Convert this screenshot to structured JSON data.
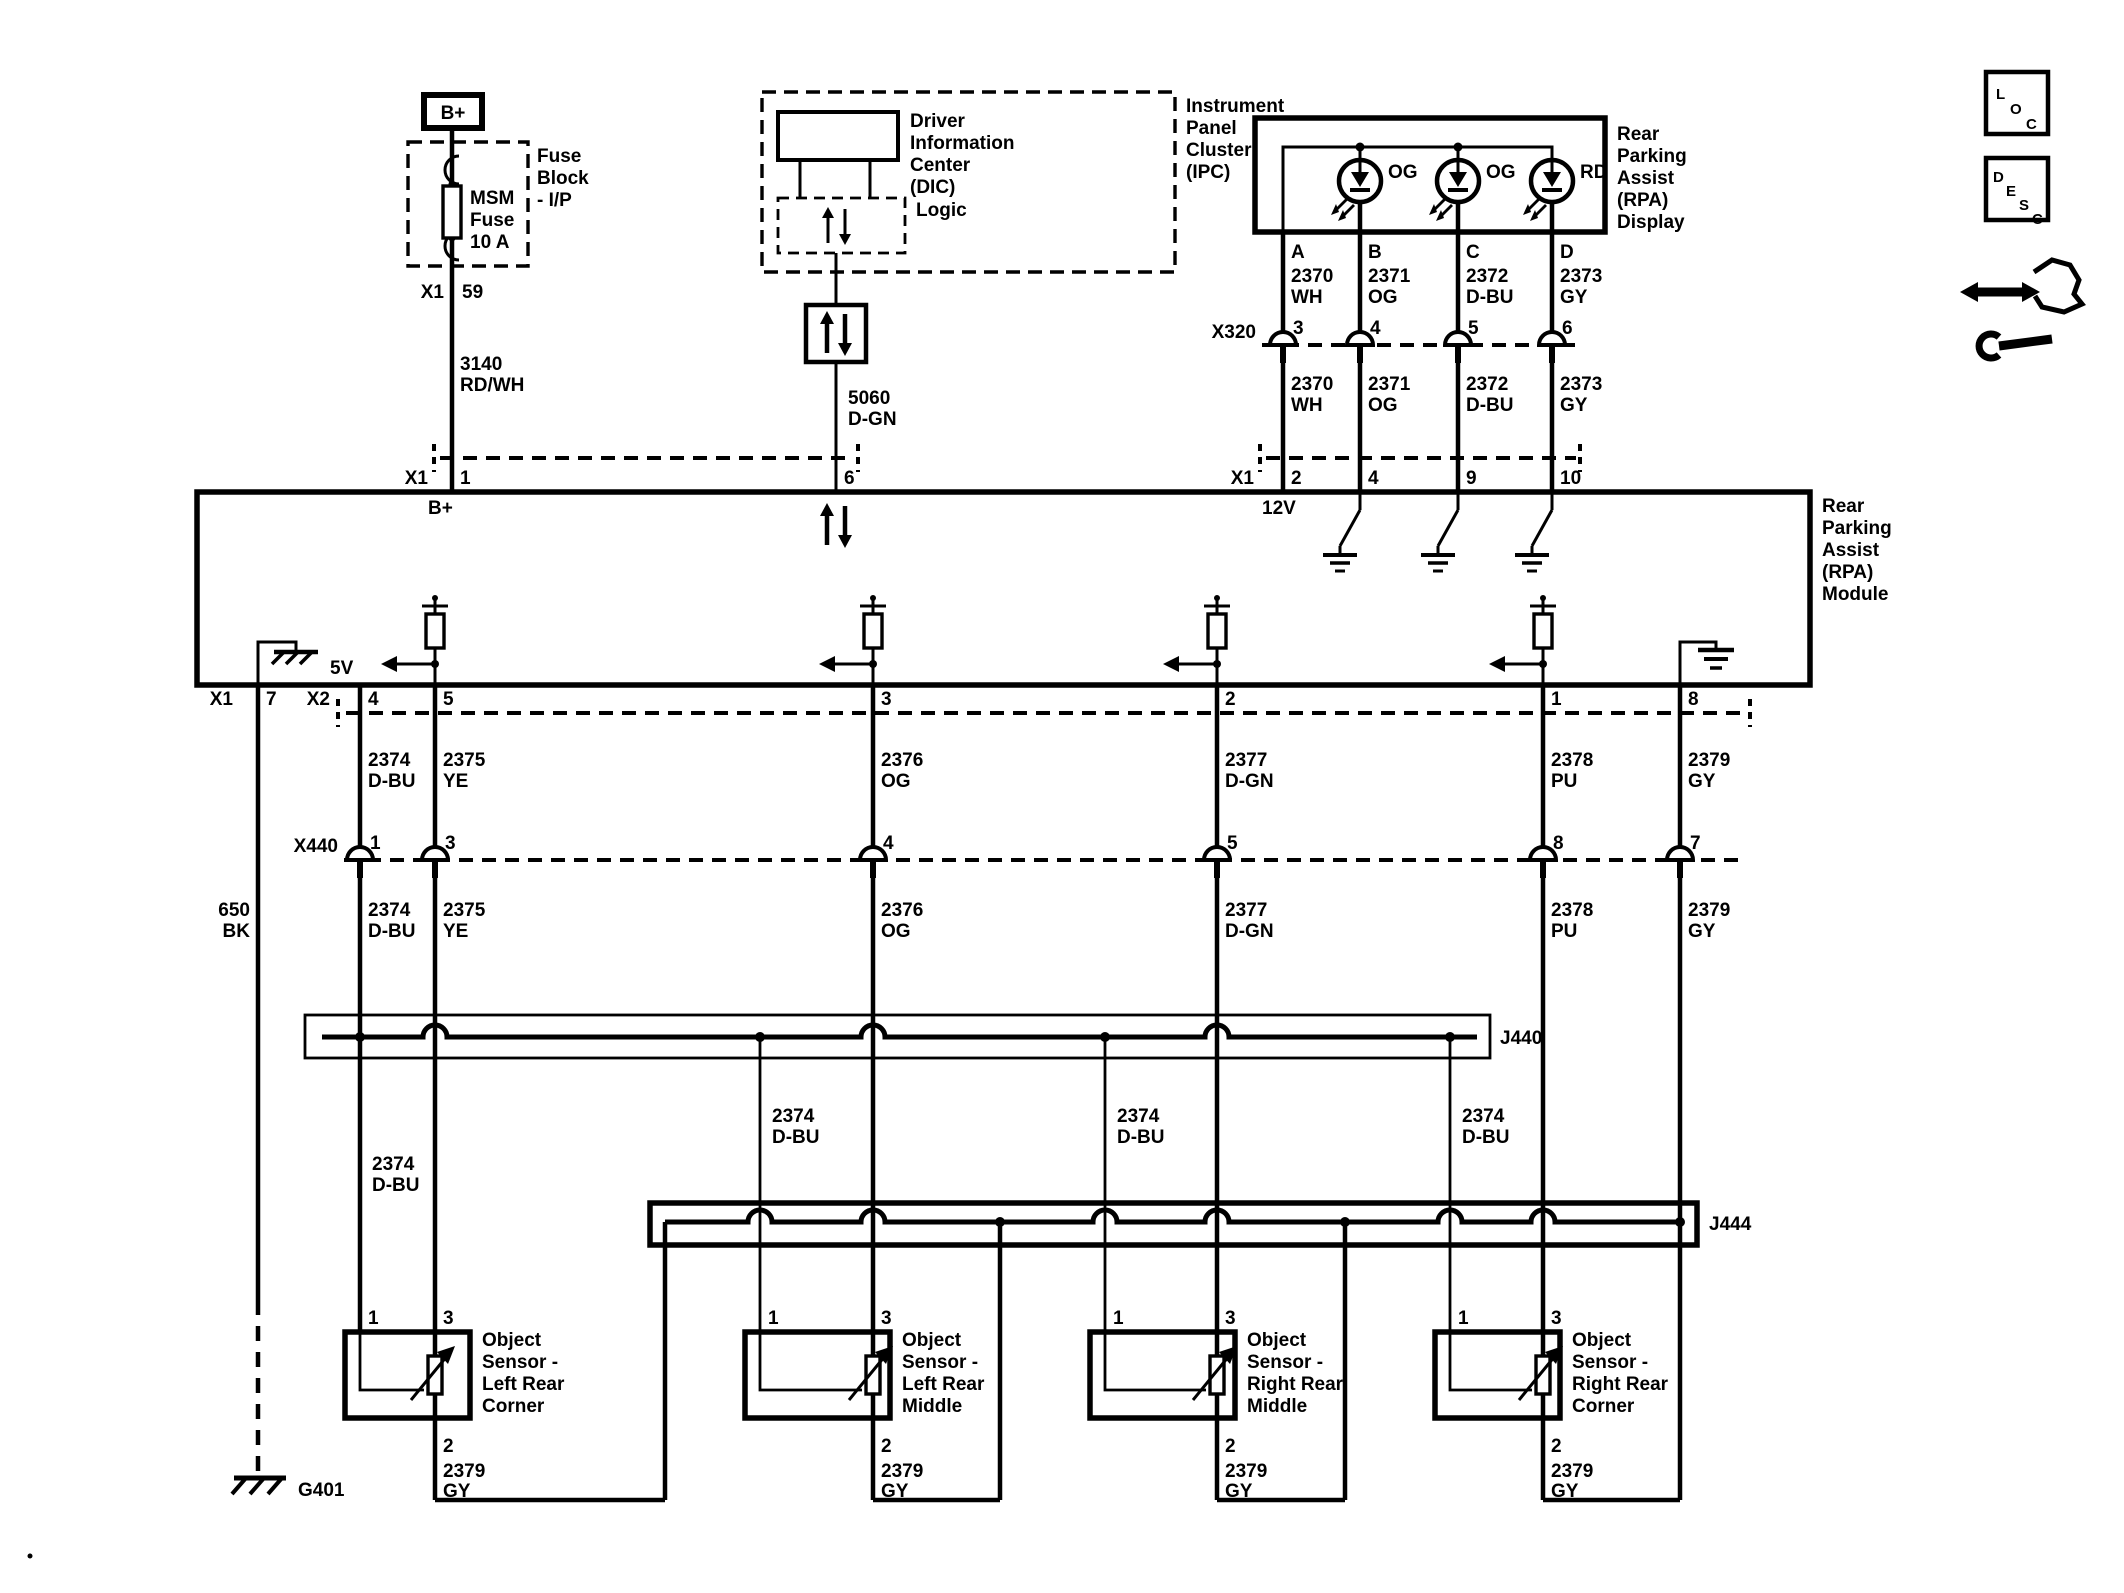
{
  "fuse": {
    "b_plus": "B+",
    "block_lines": [
      "Fuse",
      "Block",
      "- I/P"
    ],
    "name_lines": [
      "MSM",
      "Fuse",
      "10 A"
    ],
    "conn": "X1",
    "pin": "59"
  },
  "w3140": [
    "3140",
    "RD/WH"
  ],
  "ipc": {
    "label": [
      "Instrument",
      "Panel",
      "Cluster",
      "(IPC)"
    ],
    "dic": [
      "Driver",
      "Information",
      "Center",
      "(DIC)"
    ],
    "logic": "Logic"
  },
  "w5060": [
    "5060",
    "D-GN"
  ],
  "display": {
    "label": [
      "Rear",
      "Parking",
      "Assist",
      "(RPA)",
      "Display"
    ],
    "leds": [
      "OG",
      "OG",
      "RD"
    ],
    "pins": [
      "A",
      "B",
      "C",
      "D"
    ]
  },
  "w2370": [
    "2370",
    "WH"
  ],
  "w2371": [
    "2371",
    "OG"
  ],
  "w2372": [
    "2372",
    "D-BU"
  ],
  "w2373": [
    "2373",
    "GY"
  ],
  "x320": {
    "label": "X320",
    "pins": [
      "3",
      "4",
      "5",
      "6"
    ]
  },
  "x1_display": {
    "label": "X1",
    "pins": [
      "2",
      "4",
      "9",
      "10"
    ]
  },
  "x1_left": {
    "label": "X1",
    "pin1": "1",
    "pin6": "6"
  },
  "module": {
    "label": [
      "Rear",
      "Parking",
      "Assist",
      "(RPA)",
      "Module"
    ],
    "b_plus": "B+",
    "v12": "12V",
    "v5": "5V"
  },
  "x1_gnd": {
    "label": "X1",
    "pin": "7"
  },
  "x2": {
    "label": "X2",
    "pins": [
      "4",
      "5",
      "3",
      "2",
      "1",
      "8"
    ]
  },
  "x440": {
    "label": "X440",
    "pins": [
      "1",
      "3",
      "4",
      "5",
      "8",
      "7"
    ]
  },
  "w650": [
    "650",
    "BK"
  ],
  "w2374": [
    "2374",
    "D-BU"
  ],
  "w2375": [
    "2375",
    "YE"
  ],
  "w2376": [
    "2376",
    "OG"
  ],
  "w2377": [
    "2377",
    "D-GN"
  ],
  "w2378": [
    "2378",
    "PU"
  ],
  "w2379": [
    "2379",
    "GY"
  ],
  "j440": "J440",
  "j444": "J444",
  "g401": "G401",
  "sensors": [
    {
      "p1": "1",
      "p3": "3",
      "p2": "2",
      "name": [
        "Object",
        "Sensor -",
        "Left Rear",
        "Corner"
      ]
    },
    {
      "p1": "1",
      "p3": "3",
      "p2": "2",
      "name": [
        "Object",
        "Sensor -",
        "Left Rear",
        "Middle"
      ]
    },
    {
      "p1": "1",
      "p3": "3",
      "p2": "2",
      "name": [
        "Object",
        "Sensor -",
        "Right Rear",
        "Middle"
      ]
    },
    {
      "p1": "1",
      "p3": "3",
      "p2": "2",
      "name": [
        "Object",
        "Sensor -",
        "Right Rear",
        "Corner"
      ]
    }
  ],
  "icons": {
    "loc": [
      "L",
      "O",
      "C"
    ],
    "desc": [
      "D",
      "E",
      "S",
      "C"
    ]
  }
}
